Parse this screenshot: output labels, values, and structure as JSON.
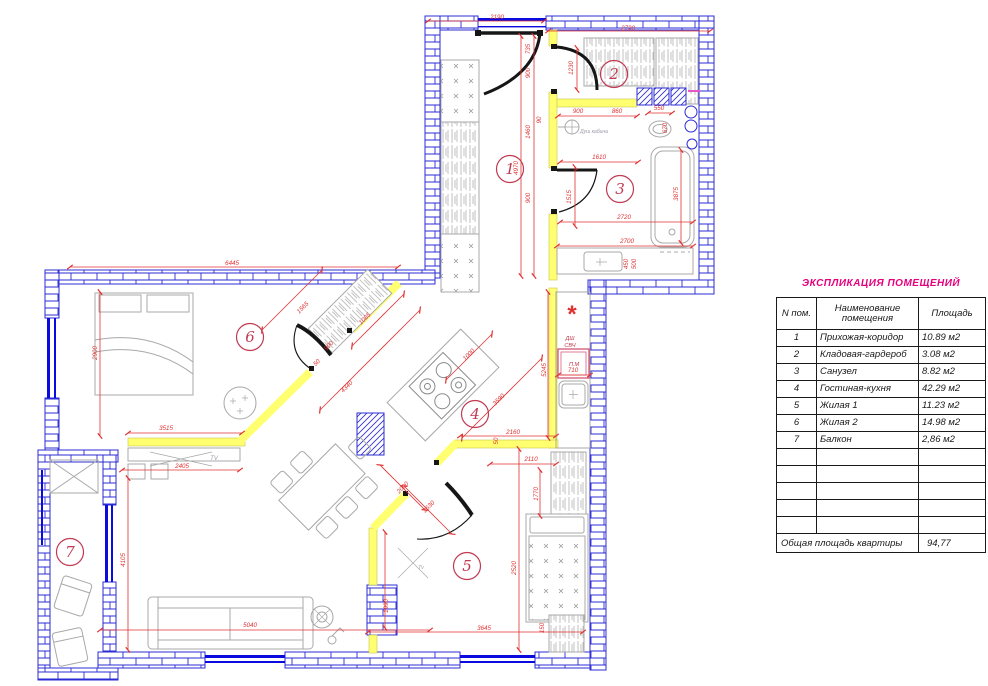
{
  "table": {
    "title": "ЭКСПЛИКАЦИЯ ПОМЕЩЕНИЙ",
    "headers": {
      "num": "N пом.",
      "name1": "Наименование",
      "name2": "помещения",
      "area": "Площадь"
    },
    "rows": [
      {
        "num": "1",
        "name": "Прихожая-коридор",
        "area": "10.89 м2"
      },
      {
        "num": "2",
        "name": "Кладовая-гардероб",
        "area": "3.08 м2"
      },
      {
        "num": "3",
        "name": "Санузел",
        "area": "8.82 м2"
      },
      {
        "num": "4",
        "name": "Гостиная-кухня",
        "area": "42.29 м2"
      },
      {
        "num": "5",
        "name": "Жилая 1",
        "area": "11.23 м2"
      },
      {
        "num": "6",
        "name": "Жилая 2",
        "area": "14.98 м2"
      },
      {
        "num": "7",
        "name": "Балкон",
        "area": "2,86 м2"
      }
    ],
    "empty_rows": 5,
    "total_label": "Общая площадь квартиры",
    "total_value": "94,77"
  },
  "plan": {
    "rooms": [
      {
        "n": "1",
        "x": 510,
        "y": 169
      },
      {
        "n": "2",
        "x": 614,
        "y": 74
      },
      {
        "n": "3",
        "x": 620,
        "y": 189
      },
      {
        "n": "4",
        "x": 475,
        "y": 414
      },
      {
        "n": "5",
        "x": 467,
        "y": 566
      },
      {
        "n": "6",
        "x": 250,
        "y": 337
      },
      {
        "n": "7",
        "x": 70,
        "y": 552
      }
    ],
    "dimensions": [
      {
        "t": "2190",
        "x": 497,
        "y": 19,
        "r": 0
      },
      {
        "t": "2720",
        "x": 628,
        "y": 30,
        "r": 0
      },
      {
        "t": "6445",
        "x": 232,
        "y": 265,
        "r": 0
      },
      {
        "t": "735",
        "x": 530,
        "y": 49,
        "r": -90
      },
      {
        "t": "900",
        "x": 530,
        "y": 73,
        "r": -90
      },
      {
        "t": "1460",
        "x": 530,
        "y": 132,
        "r": -90
      },
      {
        "t": "900",
        "x": 530,
        "y": 198,
        "r": -90
      },
      {
        "t": "4970",
        "x": 518,
        "y": 168,
        "r": -90
      },
      {
        "t": "1230",
        "x": 573,
        "y": 68,
        "r": -90
      },
      {
        "t": "900",
        "x": 578,
        "y": 113,
        "r": 0
      },
      {
        "t": "860",
        "x": 617,
        "y": 113,
        "r": 0
      },
      {
        "t": "90",
        "x": 541,
        "y": 120,
        "r": -90,
        "s": 5
      },
      {
        "t": "550",
        "x": 659,
        "y": 110,
        "r": 0,
        "s": 5.5
      },
      {
        "t": "670",
        "x": 667,
        "y": 128,
        "r": -90,
        "s": 5.5
      },
      {
        "t": "1610",
        "x": 599,
        "y": 159,
        "r": 0
      },
      {
        "t": "1515",
        "x": 571,
        "y": 197,
        "r": -90
      },
      {
        "t": "3875",
        "x": 678,
        "y": 194,
        "r": -90
      },
      {
        "t": "2720",
        "x": 624,
        "y": 219,
        "r": 0
      },
      {
        "t": "2700",
        "x": 627,
        "y": 243,
        "r": 0
      },
      {
        "t": "450",
        "x": 628,
        "y": 264,
        "r": -90,
        "s": 5
      },
      {
        "t": "500",
        "x": 636,
        "y": 264,
        "r": -90,
        "s": 5
      },
      {
        "t": "2900",
        "x": 97,
        "y": 353,
        "r": -90
      },
      {
        "t": "1565",
        "x": 304,
        "y": 309,
        "r": -45
      },
      {
        "t": "1085",
        "x": 366,
        "y": 320,
        "r": -45
      },
      {
        "t": "900",
        "x": 330,
        "y": 347,
        "r": -45,
        "s": 5.5
      },
      {
        "t": "50",
        "x": 318,
        "y": 364,
        "r": -45,
        "s": 5
      },
      {
        "t": "4340",
        "x": 348,
        "y": 388,
        "r": -45
      },
      {
        "t": "3590",
        "x": 500,
        "y": 401,
        "r": -45
      },
      {
        "t": "1000",
        "x": 470,
        "y": 356,
        "r": -45
      },
      {
        "t": "3515",
        "x": 166,
        "y": 430,
        "r": 0
      },
      {
        "t": "2405",
        "x": 182,
        "y": 468,
        "r": 0
      },
      {
        "t": "4105",
        "x": 125,
        "y": 560,
        "r": -90
      },
      {
        "t": "5040",
        "x": 250,
        "y": 627,
        "r": 0
      },
      {
        "t": "2160",
        "x": 513,
        "y": 434,
        "r": 0
      },
      {
        "t": "50",
        "x": 498,
        "y": 441,
        "r": -90,
        "s": 5
      },
      {
        "t": "2110",
        "x": 531,
        "y": 461,
        "r": 0
      },
      {
        "t": "1770",
        "x": 538,
        "y": 494,
        "r": -90
      },
      {
        "t": "5245",
        "x": 546,
        "y": 370,
        "r": -90
      },
      {
        "t": "710",
        "x": 573,
        "y": 372,
        "r": 0,
        "s": 5.5
      },
      {
        "t": "2630",
        "x": 430,
        "y": 508,
        "r": -45
      },
      {
        "t": "2000",
        "x": 404,
        "y": 489,
        "r": -45
      },
      {
        "t": "1990",
        "x": 388,
        "y": 606,
        "r": -90
      },
      {
        "t": "2520",
        "x": 516,
        "y": 568,
        "r": -90
      },
      {
        "t": "3645",
        "x": 484,
        "y": 630,
        "r": 0
      },
      {
        "t": "150",
        "x": 544,
        "y": 628,
        "r": -90,
        "s": 5
      }
    ],
    "annotations": [
      {
        "t": "*",
        "x": 571,
        "y": 322,
        "s": 24,
        "c": "#e03131",
        "b": 1
      },
      {
        "t": "ДШ",
        "x": 570,
        "y": 340,
        "s": 5.5,
        "c": "#c03344"
      },
      {
        "t": "СВЧ",
        "x": 570,
        "y": 347,
        "s": 5.5,
        "c": "#c03344"
      },
      {
        "t": "П.М",
        "x": 574,
        "y": 366,
        "s": 5.5,
        "c": "#c03344"
      },
      {
        "t": "Душ кабина",
        "x": 594,
        "y": 133,
        "s": 5,
        "c": "#9a9aa8"
      },
      {
        "t": "TV",
        "x": 214,
        "y": 460,
        "s": 6,
        "c": "#9a9aa8"
      },
      {
        "t": "Tv",
        "x": 421,
        "y": 569,
        "s": 5,
        "c": "#9a9aa8"
      }
    ]
  },
  "colors": {
    "wall_blue": "#2b2bd5",
    "window_blue": "#0b0be0",
    "partition_yellow": "#ffff70",
    "dimension_red": "#e03131",
    "room_circle_crimson": "#c13a52",
    "title_magenta": "#e6007e",
    "furniture_gray": "#a8a8a8",
    "door_black": "#161616"
  }
}
